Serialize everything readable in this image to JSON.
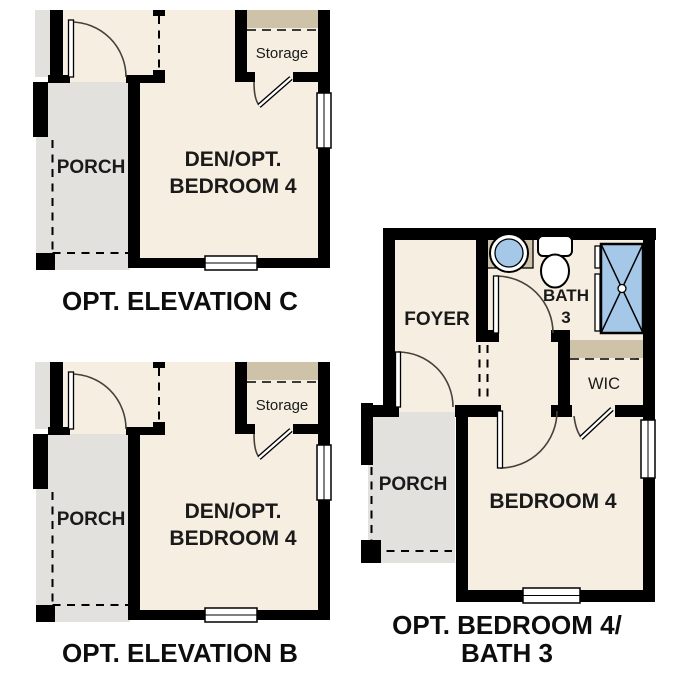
{
  "colors": {
    "room_fill": "#f6eee1",
    "porch_fill": "#e2e1dd",
    "shelf_tan": "#cec2a9",
    "fixture_blue": "#a6c8e8",
    "wall": "#000000",
    "label_ink": "#1a1a1a",
    "caption_ink": "#0d0d0d"
  },
  "elevation_plans": {
    "room_labels": {
      "porch": "PORCH",
      "den_line1": "DEN/OPT.",
      "den_line2": "BEDROOM 4",
      "storage": "Storage"
    },
    "plan_c_caption": "OPT. ELEVATION C",
    "plan_b_caption": "OPT. ELEVATION B"
  },
  "bedroom4_plan": {
    "room_labels": {
      "foyer": "FOYER",
      "bath_line1": "BATH",
      "bath_line2": "3",
      "wic": "WIC",
      "porch": "PORCH",
      "bedroom": "BEDROOM 4"
    },
    "caption_line1": "OPT. BEDROOM 4/",
    "caption_line2": "BATH 3"
  }
}
